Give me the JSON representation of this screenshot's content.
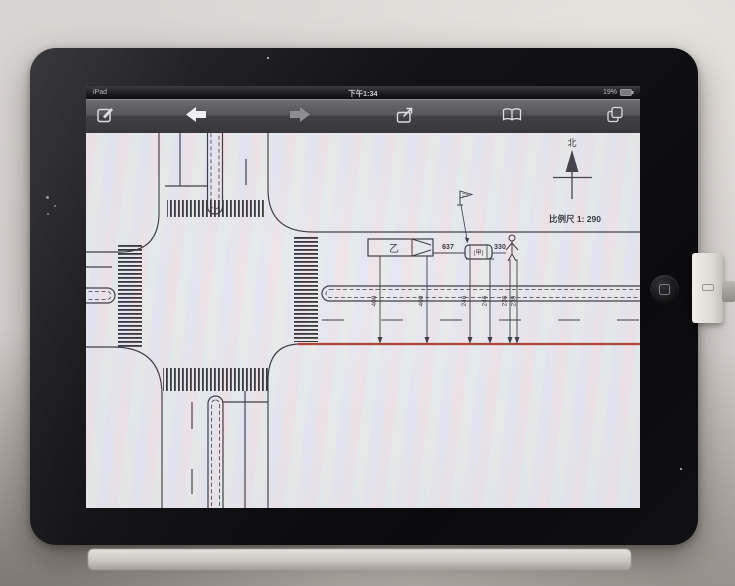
{
  "status_bar": {
    "carrier": "iPad",
    "time": "下午1:34",
    "battery": "19%"
  },
  "toolbar": {
    "icons": [
      "compose",
      "back",
      "forward",
      "share",
      "bookmarks",
      "pages"
    ]
  },
  "diagram": {
    "north_label": "北",
    "scale_label": "比例尺 1: 290",
    "vehicles": {
      "truck": "乙",
      "car": "(甲)"
    },
    "distances": {
      "truck_to_car": "637",
      "car_to_person": "330"
    },
    "offsets": [
      "400",
      "400",
      "246",
      "246",
      "236",
      "239"
    ],
    "road_edge_color": "#b5372c",
    "line_color": "#34343a"
  }
}
